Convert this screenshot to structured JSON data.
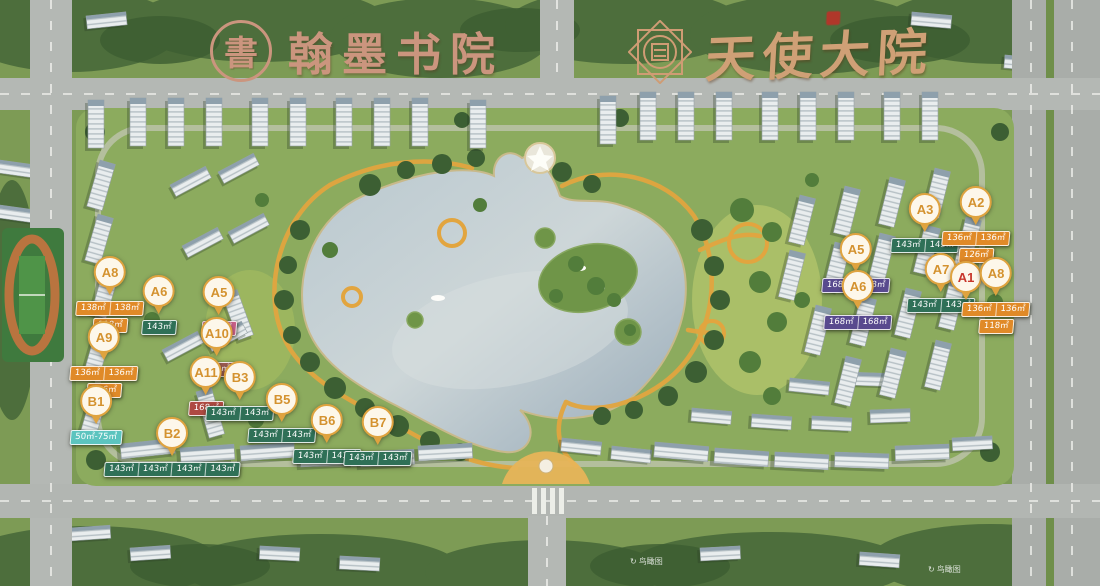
{
  "logos": {
    "left": {
      "seal_char": "書",
      "title": "翰墨书院",
      "color": "#cb957e"
    },
    "right": {
      "title": "天使大院",
      "color": "#cfa076"
    }
  },
  "watermark": {
    "text": "鸟瞰图",
    "icon": "↻"
  },
  "colors": {
    "marker_gold": "#d4922f",
    "marker_red": "#c8372c",
    "tag_orange": "#e08a28",
    "tag_green": "#2f7057",
    "tag_pink": "#c75f87",
    "tag_dark_red": "#9a5a50",
    "tag_red": "#ae4a42",
    "tag_purple": "#584a8e",
    "tag_cyan": "#5cc4bf"
  },
  "markers": [
    {
      "id": "A8-west",
      "label": "A8",
      "x": 110,
      "y": 271,
      "label_color": "marker_gold",
      "rows": [
        {
          "color": "tag_orange",
          "cells": [
            "138㎡",
            "138㎡"
          ]
        },
        {
          "color": "tag_orange",
          "cells": [
            "118㎡"
          ]
        }
      ]
    },
    {
      "id": "A6-west",
      "label": "A6",
      "x": 159,
      "y": 290,
      "label_color": "marker_gold",
      "rows": [
        {
          "color": "tag_green",
          "cells": [
            "143㎡"
          ]
        }
      ]
    },
    {
      "id": "A5-west",
      "label": "A5",
      "x": 219,
      "y": 291,
      "label_color": "marker_gold",
      "rows": [
        {
          "color": "tag_pink",
          "cells": [
            "140㎡"
          ]
        }
      ]
    },
    {
      "id": "A9",
      "label": "A9",
      "x": 104,
      "y": 336,
      "label_color": "marker_gold",
      "rows": [
        {
          "color": "tag_orange",
          "cells": [
            "136㎡",
            "136㎡"
          ]
        },
        {
          "color": "tag_orange",
          "cells": [
            "126㎡"
          ]
        }
      ]
    },
    {
      "id": "A10",
      "label": "A10",
      "x": 217,
      "y": 332,
      "label_color": "marker_gold",
      "rows": [
        {
          "color": "tag_dark_red",
          "cells": [
            "168㎡"
          ]
        }
      ]
    },
    {
      "id": "A11",
      "label": "A11",
      "x": 206,
      "y": 371,
      "label_color": "marker_gold",
      "rows": [
        {
          "color": "tag_red",
          "cells": [
            "168㎡"
          ]
        }
      ]
    },
    {
      "id": "B3",
      "label": "B3",
      "x": 240,
      "y": 376,
      "label_color": "marker_gold",
      "rows": [
        {
          "color": "tag_green",
          "cells": [
            "143㎡",
            "143㎡"
          ]
        }
      ]
    },
    {
      "id": "B1",
      "label": "B1",
      "x": 96,
      "y": 400,
      "label_color": "marker_gold",
      "rows": [
        {
          "color": "tag_cyan",
          "cells": [
            "50㎡-75㎡"
          ]
        }
      ]
    },
    {
      "id": "B2",
      "label": "B2",
      "x": 172,
      "y": 432,
      "label_color": "marker_gold",
      "rows": [
        {
          "color": "tag_green",
          "cells": [
            "143㎡",
            "143㎡",
            "143㎡",
            "143㎡"
          ]
        }
      ]
    },
    {
      "id": "B5",
      "label": "B5",
      "x": 282,
      "y": 398,
      "label_color": "marker_gold",
      "rows": [
        {
          "color": "tag_green",
          "cells": [
            "143㎡",
            "143㎡"
          ]
        }
      ]
    },
    {
      "id": "B6",
      "label": "B6",
      "x": 327,
      "y": 419,
      "label_color": "marker_gold",
      "rows": [
        {
          "color": "tag_green",
          "cells": [
            "143㎡",
            "143㎡"
          ]
        }
      ]
    },
    {
      "id": "B7",
      "label": "B7",
      "x": 378,
      "y": 421,
      "label_color": "marker_gold",
      "rows": [
        {
          "color": "tag_green",
          "cells": [
            "143㎡",
            "143㎡"
          ]
        }
      ]
    },
    {
      "id": "A3-east",
      "label": "A3",
      "x": 925,
      "y": 208,
      "label_color": "marker_gold",
      "rows": [
        {
          "color": "tag_green",
          "cells": [
            "143㎡",
            "143㎡"
          ]
        }
      ]
    },
    {
      "id": "A2-east",
      "label": "A2",
      "x": 976,
      "y": 201,
      "label_color": "marker_gold",
      "rows": [
        {
          "color": "tag_orange",
          "cells": [
            "136㎡",
            "136㎡"
          ]
        },
        {
          "color": "tag_orange",
          "cells": [
            "126㎡"
          ]
        }
      ]
    },
    {
      "id": "A5-east",
      "label": "A5",
      "x": 856,
      "y": 248,
      "label_color": "marker_gold",
      "rows": [
        {
          "color": "tag_purple",
          "cells": [
            "168㎡",
            "168㎡"
          ]
        }
      ]
    },
    {
      "id": "A6-east",
      "label": "A6",
      "x": 858,
      "y": 285,
      "label_color": "marker_gold",
      "rows": [
        {
          "color": "tag_purple",
          "cells": [
            "168㎡",
            "168㎡"
          ]
        }
      ]
    },
    {
      "id": "A7-east",
      "label": "A7",
      "x": 941,
      "y": 268,
      "label_color": "marker_gold",
      "rows": [
        {
          "color": "tag_green",
          "cells": [
            "143㎡",
            "143㎡"
          ]
        }
      ]
    },
    {
      "id": "A1-east",
      "label": "A1",
      "x": 966,
      "y": 276,
      "label_color": "marker_red",
      "rows": []
    },
    {
      "id": "A8-east",
      "label": "A8",
      "x": 996,
      "y": 272,
      "label_color": "marker_gold",
      "rows": [
        {
          "color": "tag_orange",
          "cells": [
            "136㎡",
            "136㎡"
          ]
        },
        {
          "color": "tag_orange",
          "cells": [
            "118㎡"
          ]
        }
      ]
    }
  ]
}
